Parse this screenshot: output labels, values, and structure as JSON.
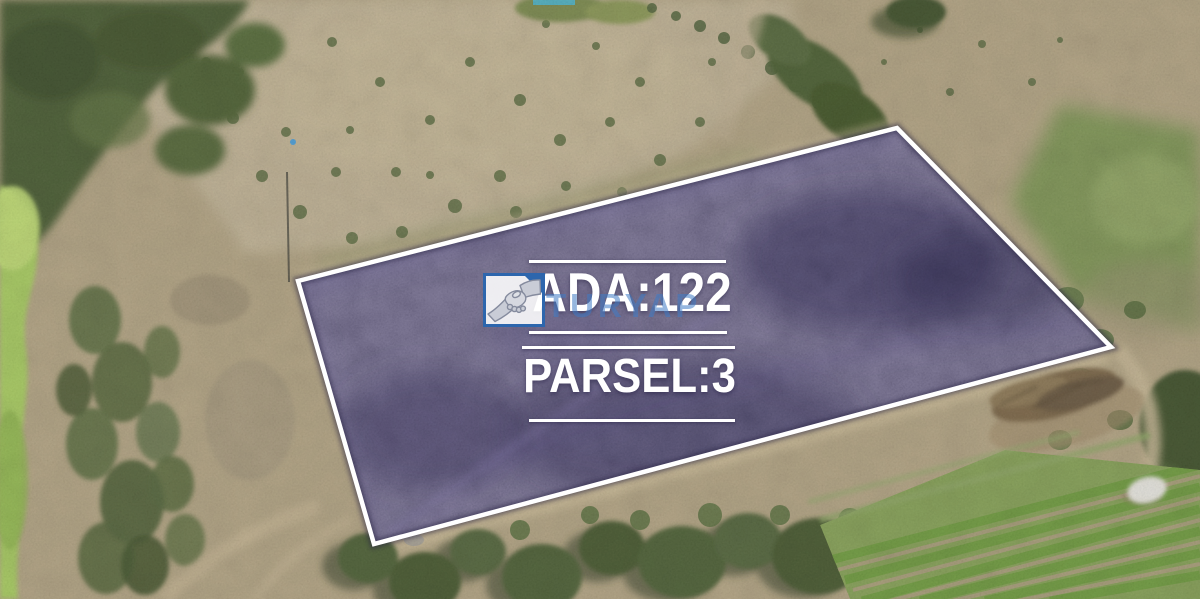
{
  "scene": {
    "type": "aerial drone photograph",
    "subject": "dry farmland with a purple-highlighted cadastral land parcel outlined in white"
  },
  "parcel": {
    "ada_label": "ADA:122",
    "parsel_label": "PARSEL:3",
    "fill_color": "#4a4172",
    "outline_color": "#ffffff",
    "label_text_color": "#ffffff"
  },
  "watermark": {
    "text": "TURYAP",
    "text_color": "#3e7ac5",
    "logo_icon": "handshake-icon",
    "logo_frame_color": "#2d66ad"
  }
}
